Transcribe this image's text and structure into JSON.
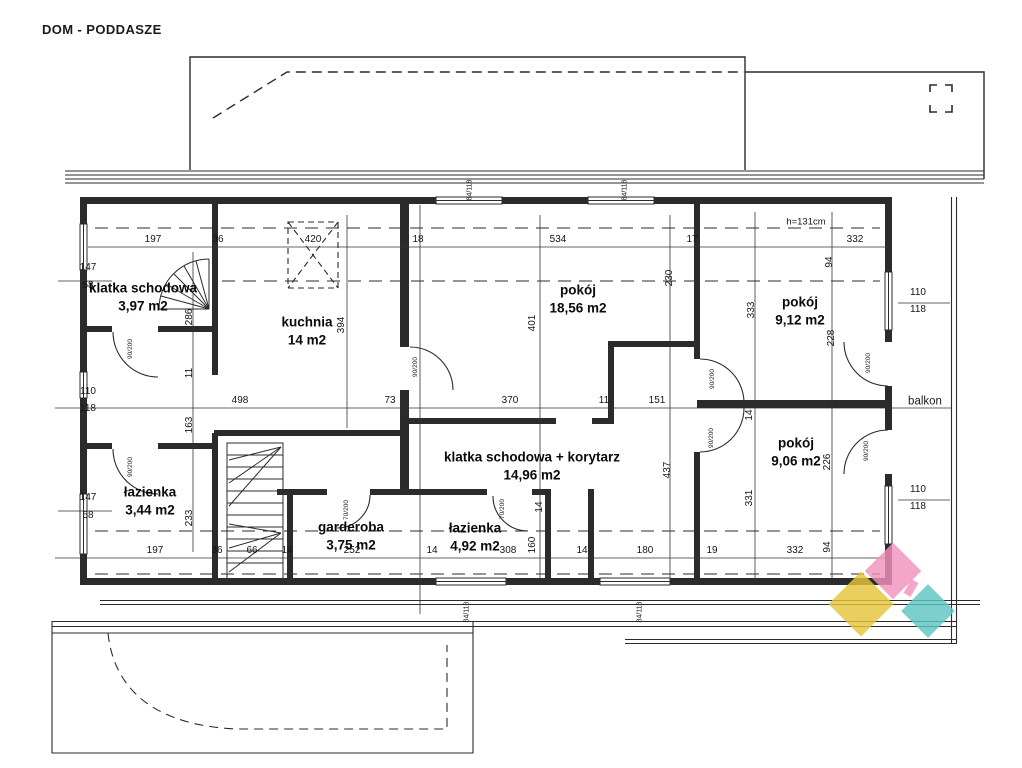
{
  "title": "DOM - PODDASZE",
  "plan": {
    "rooms": [
      {
        "id": "klatka-schodowa-1",
        "name": "klatka schodowa",
        "area": "3,97 m2",
        "x": 143,
        "y": 288
      },
      {
        "id": "kuchnia",
        "name": "kuchnia",
        "area": "14 m2",
        "x": 307,
        "y": 322
      },
      {
        "id": "pokoj-1856",
        "name": "pokój",
        "area": "18,56 m2",
        "x": 578,
        "y": 290
      },
      {
        "id": "pokoj-912",
        "name": "pokój",
        "area": "9,12 m2",
        "x": 800,
        "y": 302
      },
      {
        "id": "lazienka-344",
        "name": "łazienka",
        "area": "3,44 m2",
        "x": 150,
        "y": 492
      },
      {
        "id": "klatka-korytarz",
        "name": "klatka schodowa + korytarz",
        "area": "14,96 m2",
        "x": 532,
        "y": 457
      },
      {
        "id": "garderoba",
        "name": "garderoba",
        "area": "3,75 m2",
        "x": 351,
        "y": 527
      },
      {
        "id": "lazienka-492",
        "name": "łazienka",
        "area": "4,92 m2",
        "x": 475,
        "y": 528
      },
      {
        "id": "pokoj-906",
        "name": "pokój",
        "area": "9,06 m2",
        "x": 796,
        "y": 443
      },
      {
        "id": "balkon",
        "name": "balkon",
        "area": "",
        "x": 925,
        "y": 402,
        "cls": "balkon"
      }
    ],
    "dims": [
      {
        "t": "197",
        "x": 153,
        "y": 240
      },
      {
        "t": "36",
        "x": 218,
        "y": 240
      },
      {
        "t": "420",
        "x": 313,
        "y": 240
      },
      {
        "t": "18",
        "x": 418,
        "y": 240
      },
      {
        "t": "534",
        "x": 558,
        "y": 240
      },
      {
        "t": "17",
        "x": 692,
        "y": 240
      },
      {
        "t": "332",
        "x": 855,
        "y": 240
      },
      {
        "t": "498",
        "x": 240,
        "y": 401
      },
      {
        "t": "73",
        "x": 390,
        "y": 401
      },
      {
        "t": "370",
        "x": 510,
        "y": 401
      },
      {
        "t": "11",
        "x": 604,
        "y": 401
      },
      {
        "t": "151",
        "x": 657,
        "y": 401
      },
      {
        "t": "197",
        "x": 155,
        "y": 551
      },
      {
        "t": "36",
        "x": 217,
        "y": 551
      },
      {
        "t": "66",
        "x": 252,
        "y": 551
      },
      {
        "t": "14",
        "x": 287,
        "y": 551
      },
      {
        "t": "252",
        "x": 352,
        "y": 551
      },
      {
        "t": "14",
        "x": 432,
        "y": 551
      },
      {
        "t": "308",
        "x": 508,
        "y": 551
      },
      {
        "t": "14",
        "x": 582,
        "y": 551
      },
      {
        "t": "180",
        "x": 645,
        "y": 551
      },
      {
        "t": "19",
        "x": 712,
        "y": 551
      },
      {
        "t": "332",
        "x": 795,
        "y": 551
      },
      {
        "t": "147",
        "x": 88,
        "y": 268
      },
      {
        "t": "58",
        "x": 88,
        "y": 286
      },
      {
        "t": "110",
        "x": 88,
        "y": 392
      },
      {
        "t": "118",
        "x": 88,
        "y": 409
      },
      {
        "t": "147",
        "x": 88,
        "y": 498
      },
      {
        "t": "58",
        "x": 88,
        "y": 516
      },
      {
        "t": "110",
        "x": 918,
        "y": 293
      },
      {
        "t": "118",
        "x": 918,
        "y": 310
      },
      {
        "t": "110",
        "x": 918,
        "y": 490
      },
      {
        "t": "118",
        "x": 918,
        "y": 507
      },
      {
        "t": "286",
        "x": 190,
        "y": 317,
        "r": 1
      },
      {
        "t": "11",
        "x": 190,
        "y": 373,
        "r": 1
      },
      {
        "t": "163",
        "x": 190,
        "y": 425,
        "r": 1
      },
      {
        "t": "233",
        "x": 190,
        "y": 518,
        "r": 1
      },
      {
        "t": "394",
        "x": 342,
        "y": 325,
        "r": 1
      },
      {
        "t": "401",
        "x": 533,
        "y": 323,
        "r": 1
      },
      {
        "t": "160",
        "x": 533,
        "y": 545,
        "r": 1
      },
      {
        "t": "14",
        "x": 540,
        "y": 507,
        "r": 1
      },
      {
        "t": "230",
        "x": 670,
        "y": 278,
        "r": 1
      },
      {
        "t": "437",
        "x": 668,
        "y": 470,
        "r": 1
      },
      {
        "t": "333",
        "x": 752,
        "y": 310,
        "r": 1
      },
      {
        "t": "331",
        "x": 750,
        "y": 498,
        "r": 1
      },
      {
        "t": "94",
        "x": 830,
        "y": 262,
        "r": 1
      },
      {
        "t": "228",
        "x": 832,
        "y": 338,
        "r": 1
      },
      {
        "t": "226",
        "x": 828,
        "y": 462,
        "r": 1
      },
      {
        "t": "94",
        "x": 828,
        "y": 547,
        "r": 1
      },
      {
        "t": "14",
        "x": 750,
        "y": 415,
        "r": 1
      },
      {
        "t": "84/118",
        "x": 470,
        "y": 190,
        "r": 1,
        "cls": "win"
      },
      {
        "t": "84/118",
        "x": 625,
        "y": 190,
        "r": 1,
        "cls": "win"
      },
      {
        "t": "84/118",
        "x": 467,
        "y": 612,
        "r": 1,
        "cls": "win"
      },
      {
        "t": "84/118",
        "x": 640,
        "y": 612,
        "r": 1,
        "cls": "win"
      },
      {
        "t": "90/200",
        "x": 131,
        "y": 349,
        "r": 1,
        "cls": "door"
      },
      {
        "t": "90/200",
        "x": 131,
        "y": 467,
        "r": 1,
        "cls": "door"
      },
      {
        "t": "90/200",
        "x": 416,
        "y": 367,
        "r": 1,
        "cls": "door"
      },
      {
        "t": "90/200",
        "x": 713,
        "y": 379,
        "r": 1,
        "cls": "door"
      },
      {
        "t": "90/200",
        "x": 712,
        "y": 438,
        "r": 1,
        "cls": "door"
      },
      {
        "t": "90/200",
        "x": 869,
        "y": 363,
        "r": 1,
        "cls": "door"
      },
      {
        "t": "90/200",
        "x": 867,
        "y": 451,
        "r": 1,
        "cls": "door"
      },
      {
        "t": "70/200",
        "x": 347,
        "y": 510,
        "r": 1,
        "cls": "door"
      },
      {
        "t": "70/200",
        "x": 503,
        "y": 509,
        "r": 1,
        "cls": "door"
      },
      {
        "t": "h=131cm",
        "x": 806,
        "y": 222,
        "cls": "note"
      }
    ]
  },
  "logo": {
    "yellow": "#e7c43b",
    "pink": "#f093bb",
    "teal": "#5ec6c2"
  }
}
